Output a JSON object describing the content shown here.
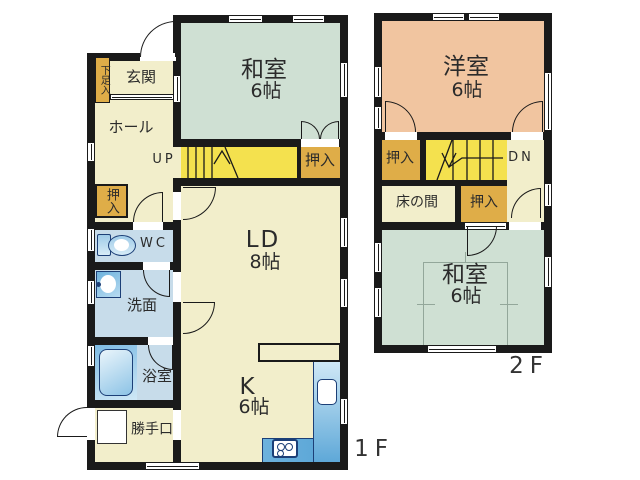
{
  "title": "2-story house floor plan",
  "colors": {
    "wall": "#1a1a1a",
    "cream": "#f2eecb",
    "green": "#cfe0d3",
    "orange": "#f1c5a0",
    "yellow": "#f4e14e",
    "mustard": "#dfad48",
    "blue": "#c7dcea",
    "fixblue": "#5ea8d8",
    "navy": "#1c3f77"
  },
  "floor1": {
    "label": "1F",
    "washitsu": {
      "name": "和室",
      "size": "6帖"
    },
    "genkan": "玄関",
    "getabako": "下足入",
    "hall": "ホール",
    "up": "UP",
    "oshiire_stairs": "押入",
    "oshiire_hall": "押入",
    "wc": "WC",
    "senmen": "洗面",
    "bath": "浴室",
    "katteguchi": "勝手口",
    "ld": {
      "name": "LD",
      "size": "8帖"
    },
    "kitchen": {
      "name": "K",
      "size": "6帖"
    }
  },
  "floor2": {
    "label": "2F",
    "yoshitsu": {
      "name": "洋室",
      "size": "6帖"
    },
    "oshiire_left": "押入",
    "dn": "DN",
    "tokonoma": "床の間",
    "oshiire_mid": "押入",
    "washitsu": {
      "name": "和室",
      "size": "6帖"
    }
  }
}
